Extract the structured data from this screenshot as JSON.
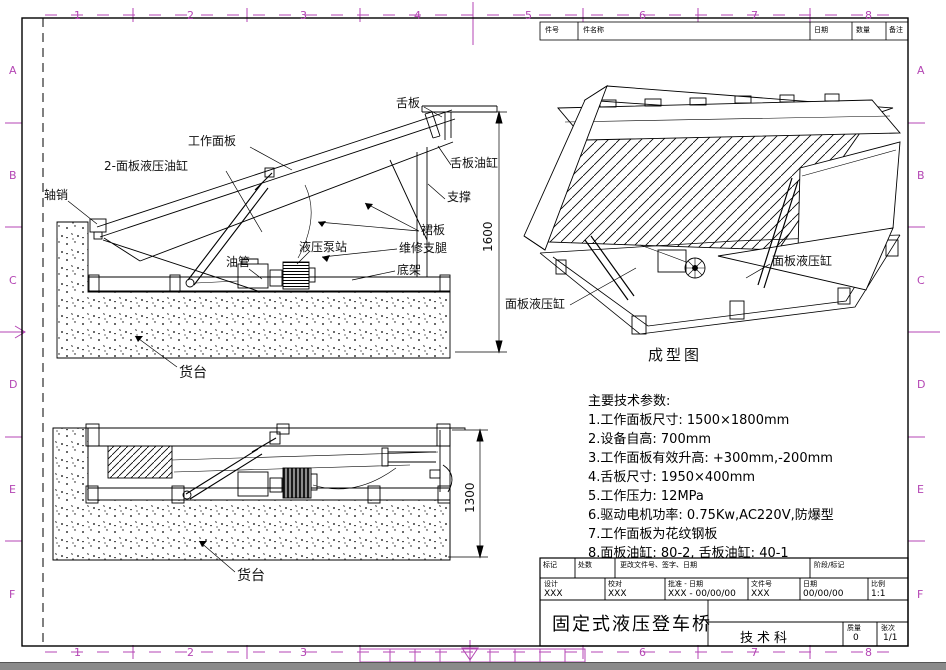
{
  "drawing": {
    "name": "固定式液压登车桥"
  },
  "grid": {
    "cols": [
      "1",
      "2",
      "3",
      "4",
      "5",
      "6",
      "7",
      "8"
    ],
    "rows": [
      "A",
      "B",
      "C",
      "D",
      "E",
      "F"
    ],
    "accent_color": "#b445b4"
  },
  "parts_strip": {
    "headers": [
      "件号",
      "件名称",
      "日期",
      "数量",
      "备注"
    ]
  },
  "upper_view": {
    "labels": {
      "axle_pin": "轴销",
      "panel_cylinders": "2-面板液压油缸",
      "work_panel": "工作面板",
      "lip_plate": "舌板",
      "lip_cylinder": "舌板油缸",
      "support": "支撑",
      "skirt_plate": "裙板",
      "maintenance_legs": "维修支腿",
      "base_frame": "底架",
      "pump_station": "液压泵站",
      "oil_pipe": "油管",
      "platform": "货台"
    },
    "dimension": "1600"
  },
  "lower_view": {
    "labels": {
      "platform": "货台"
    },
    "dimension": "1300"
  },
  "iso_view": {
    "labels": {
      "cyl_left": "面板液压缸",
      "cyl_right": "面板液压缸"
    },
    "caption": "成型图"
  },
  "params": {
    "lines": [
      "主要技术参数:",
      "1.工作面板尺寸: 1500×1800mm",
      "2.设备自高: 700mm",
      "3.工作面板有效升高: +300mm,-200mm",
      "4.舌板尺寸: 1950×400mm",
      "5.工作压力: 12MPa",
      "6.驱动电机功率: 0.75Kw,AC220V,防爆型",
      "7.工作面板为花纹钢板",
      "8.面板油缸: 80-2, 舌板油缸: 40-1"
    ]
  },
  "title_block": {
    "rev_headers": [
      "标记",
      "处数",
      "更改文件号、签字、日期",
      "阶段/标记"
    ],
    "cells": [
      {
        "label": "设计",
        "value": "XXX"
      },
      {
        "label": "校对",
        "value": "XXX"
      },
      {
        "label": "批准 - 日期",
        "value": "XXX - 00/00/00"
      },
      {
        "label": "文件号",
        "value": "XXX"
      },
      {
        "label": "日期",
        "value": "00/00/00"
      },
      {
        "label": "比例",
        "value": "1:1"
      }
    ],
    "title": "固定式液压登车桥",
    "department": "技术科",
    "weight_label": "质量",
    "weight_value": "0",
    "sheet_label": "张次",
    "sheet_value": "1/1"
  }
}
